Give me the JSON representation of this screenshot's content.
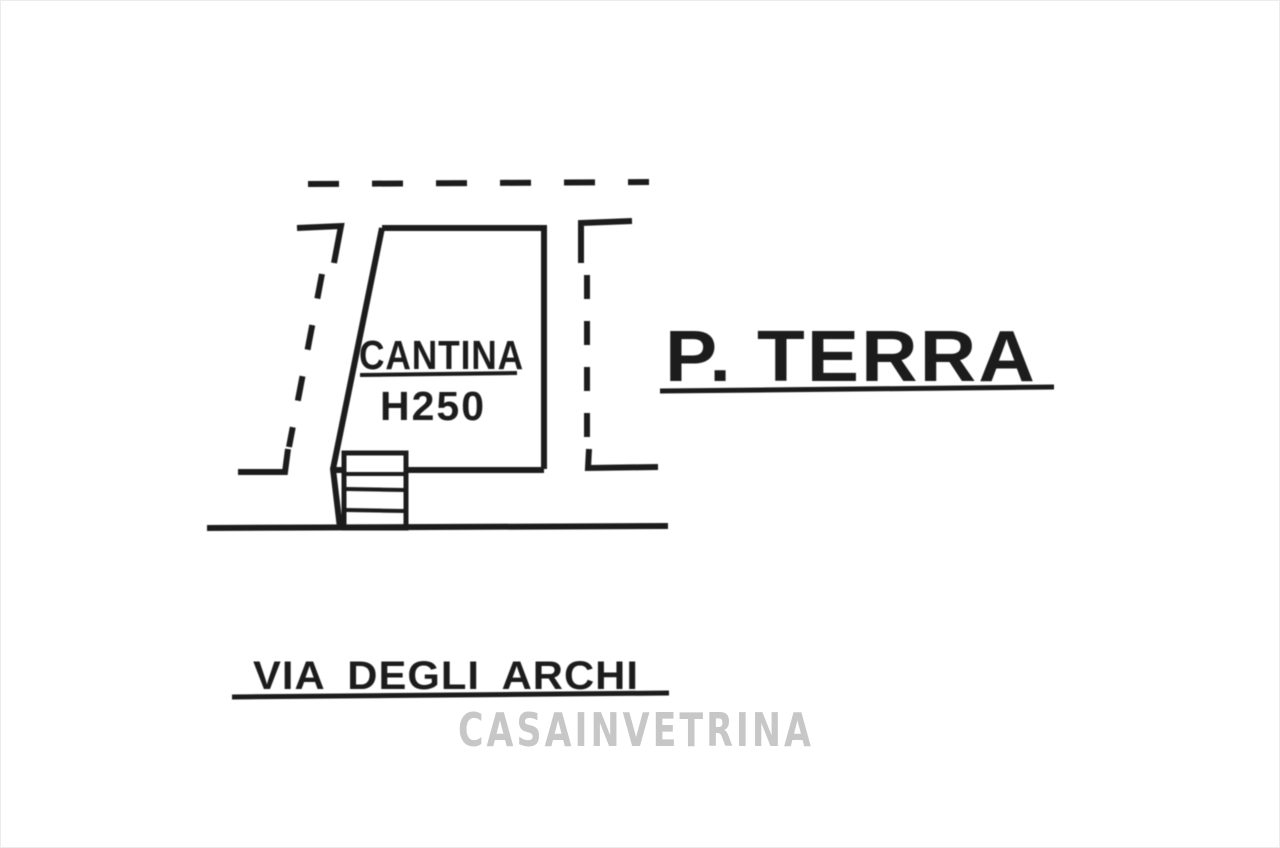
{
  "document": {
    "type": "floor-plan-sketch",
    "floorplan": {
      "room_label": "CANTINA",
      "room_height_label": "H250",
      "floor_label": "P. TERRA",
      "street_label": "VIA DEGLI ARCHI"
    },
    "watermark": "CASAINVETRINA"
  },
  "colors": {
    "background": "#ffffff",
    "ink": "#1c1c1c",
    "watermark": "#c7c7c7"
  }
}
